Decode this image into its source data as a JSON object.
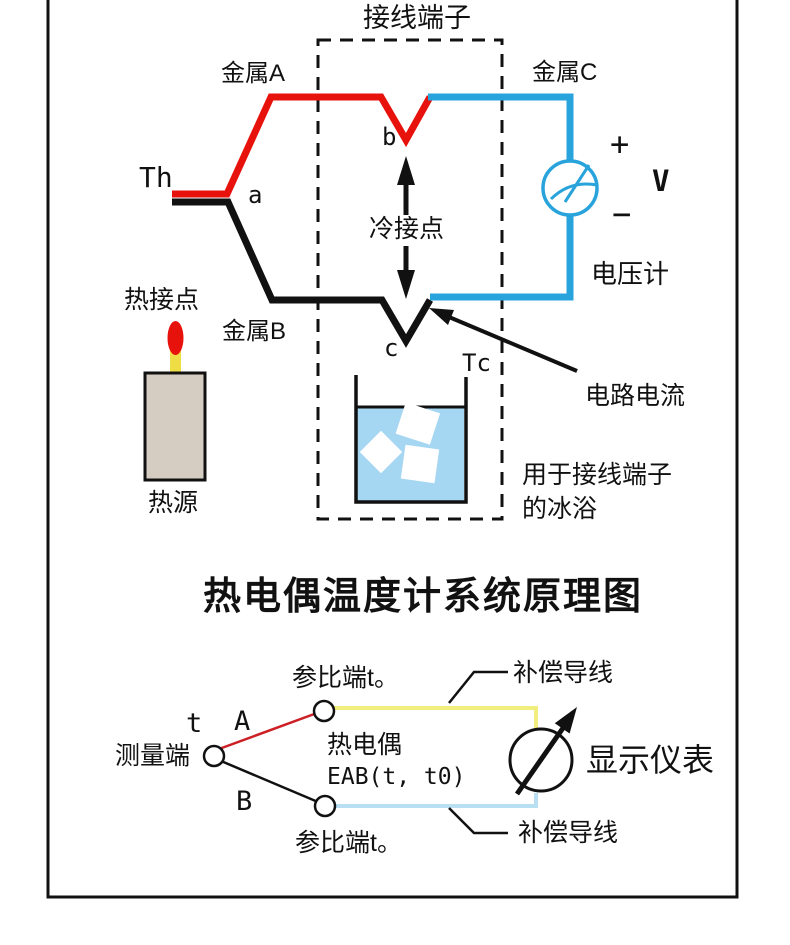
{
  "colors": {
    "wire-red": "#e8120d",
    "wire-black": "#111111",
    "wire-blue": "#29a3dc",
    "thin-red": "#cc2026",
    "comp-yellow": "#f2ee7e",
    "comp-blue": "#b9dff3",
    "water-blue": "#a5d6f2",
    "candle-tan": "#d6cdc2",
    "flame-yellow": "#eedd44"
  },
  "top_diagram": {
    "terminal_block": "接线端子",
    "metal_a": "金属A",
    "metal_b": "金属B",
    "metal_c": "金属C",
    "hot_temp": "Th",
    "cold_temp": "Tc",
    "junction_a": "a",
    "junction_b": "b",
    "junction_c": "c",
    "cold_junction": "冷接点",
    "hot_junction": "热接点",
    "heat_source": "热源",
    "plus": "+",
    "minus": "−",
    "volt_unit": "V",
    "voltmeter": "电压计",
    "circuit_current": "电路电流",
    "ice_bath_caption_line1": "用于接线端子",
    "ice_bath_caption_line2": "的冰浴"
  },
  "title": "热电偶温度计系统原理图",
  "bottom_diagram": {
    "ref_junction_top": "参比端t。",
    "ref_junction_bottom": "参比端t。",
    "comp_wire_top": "补偿导线",
    "comp_wire_bottom": "补偿导线",
    "temp_t": "t",
    "wire_a": "A",
    "wire_b": "B",
    "measuring_end": "测量端",
    "thermocouple": "热电偶",
    "emf": "EAB(t, t0)",
    "display_meter": "显示仪表"
  }
}
